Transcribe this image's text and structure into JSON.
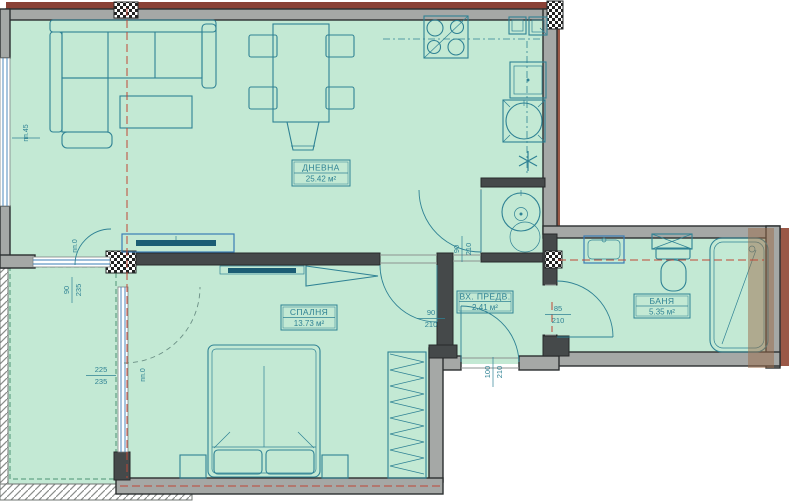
{
  "plan_type": "apartment-floor-plan",
  "rooms": {
    "living": {
      "name": "ДНЕВНА",
      "area": "25.42 м²"
    },
    "bedroom": {
      "name": "СПАЛНЯ",
      "area": "13.73 м²"
    },
    "hall": {
      "name": "ВХ. ПРЕДВ.",
      "area": "2.41 м²"
    },
    "bath": {
      "name": "БАНЯ",
      "area": "5.35 м²"
    }
  },
  "dims": {
    "parapetLeft": "пп.45",
    "livingWin": {
      "num": "90",
      "den": "235"
    },
    "parapetLiving": "пп.0",
    "bedroomWin": {
      "num": "225",
      "den": "235"
    },
    "parapetBedroom": "пп.0",
    "hallDoor": {
      "num": "90",
      "den": "210"
    },
    "bedroomDoor": {
      "num": "90",
      "den": "210"
    },
    "entryDoor": {
      "num": "100",
      "den": "210"
    },
    "bathDoor": {
      "num": "85",
      "den": "210"
    }
  },
  "colors": {
    "floor": "#c3e9d4",
    "wallLight": "#a5a8a6",
    "wallDark": "#45494a",
    "furniture": "#2f8294",
    "windowBlue": "#3a7db5",
    "centerlineRed": "#bf4636",
    "brick": "#9a5847",
    "topAccent": "#8a4136",
    "tvFill": "#1b5d74",
    "bathOverlayBrown": "#9c6b4a"
  }
}
